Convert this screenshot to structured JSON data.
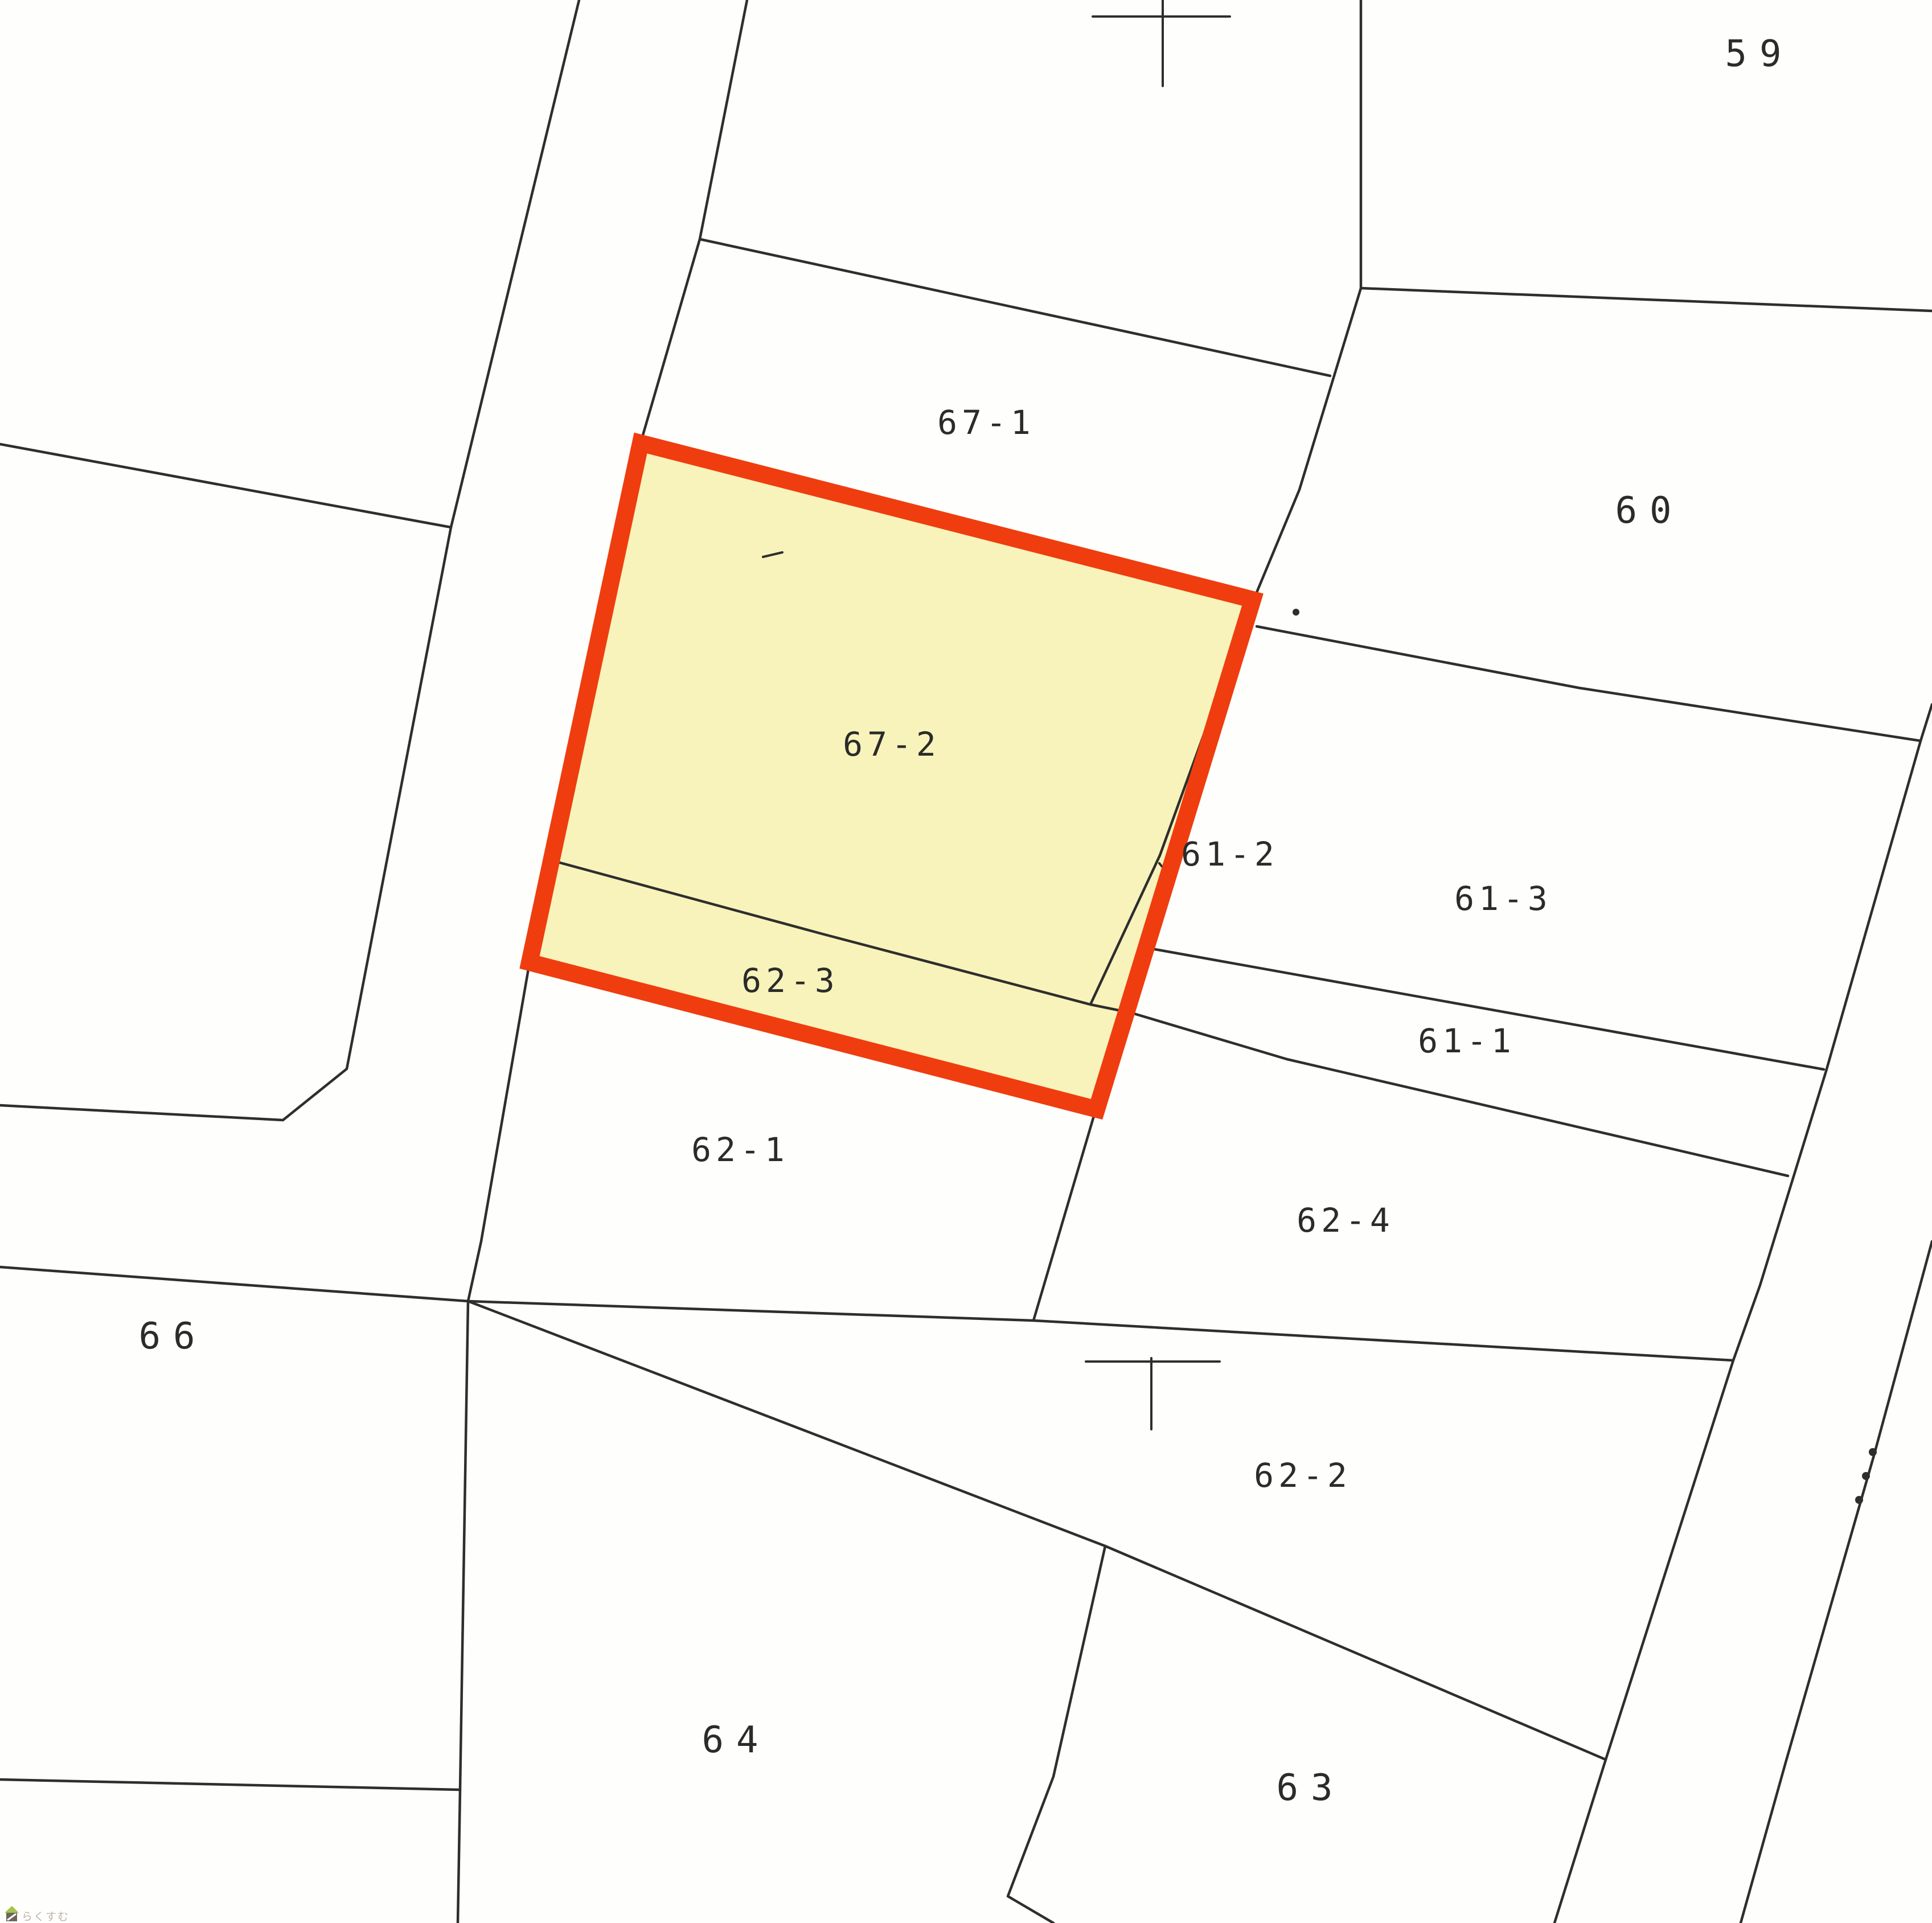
{
  "map_type": "cadastral-parcel-map",
  "colors": {
    "background": "#fefefc",
    "ink": "#2e2e2e",
    "label_ink": "#2b2b2b",
    "highlight_fill": "#f8f3ba",
    "highlight_border": "#ef3d0f",
    "watermark_text": "#beb5ac",
    "watermark_roof": "#a6c44d",
    "watermark_house": "#6f6459"
  },
  "labels": {
    "p59": "59",
    "p60": "60",
    "p61_1": "61-1",
    "p61_2": "61-2",
    "p61_3": "61-3",
    "p62_1": "62-1",
    "p62_2": "62-2",
    "p62_3": "62-3",
    "p62_4": "62-4",
    "p63": "63",
    "p64": "64",
    "p66": "66",
    "p67_1": "67-1",
    "p67_2": "67-2"
  },
  "highlighted_parcels": [
    "67-2",
    "62-3"
  ],
  "watermark": {
    "text": "らくすむ"
  },
  "marks": {
    "top_cross": "survey-cross",
    "middle_tee": "survey-tee",
    "boundary_dots": 3
  }
}
